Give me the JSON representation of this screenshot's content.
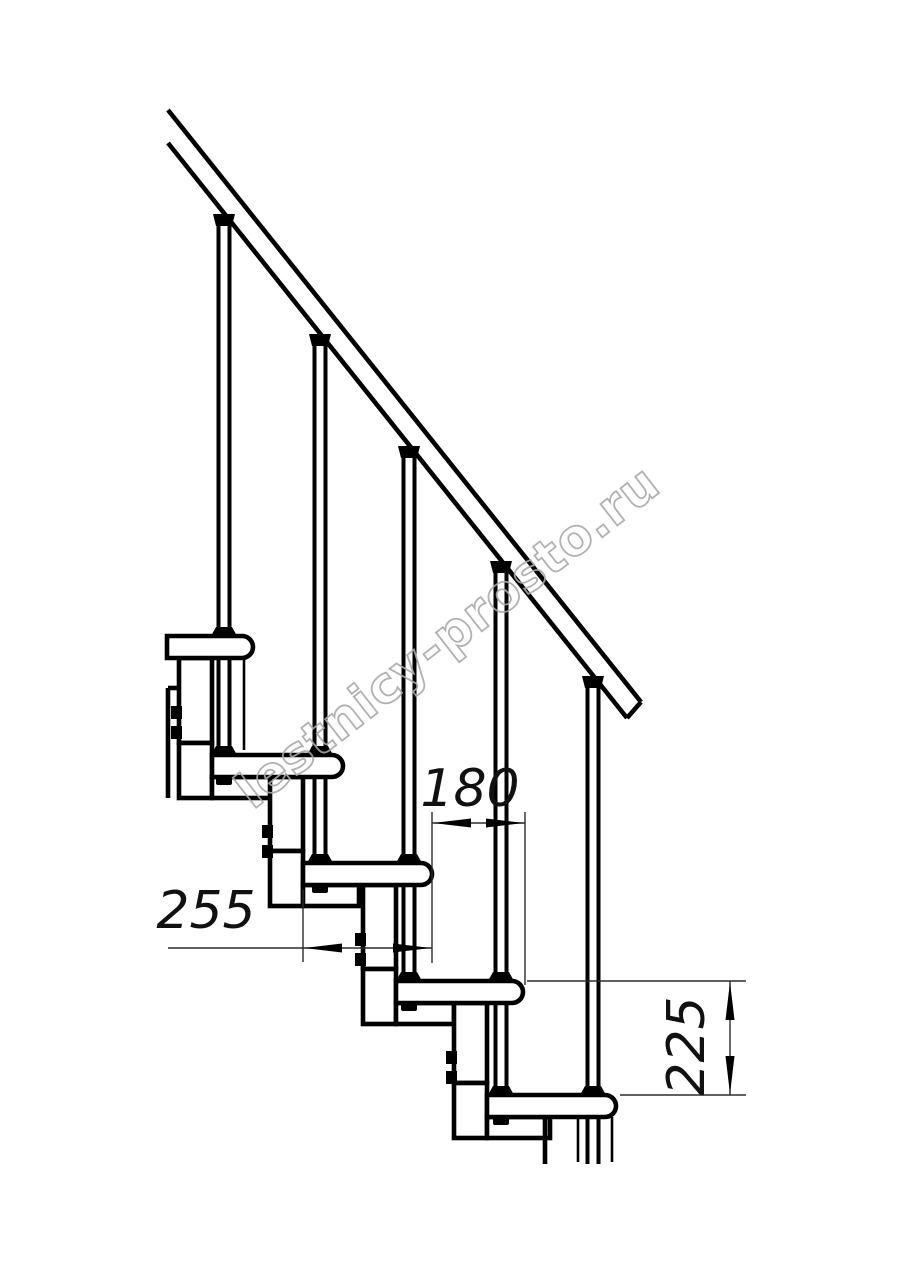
{
  "drawing": {
    "title_hint": "modular staircase side-view technical drawing",
    "watermark_text": "lestnicy-prosto.ru",
    "dimensions": {
      "step_run": "180",
      "tread_depth": "255",
      "riser_height": "225"
    },
    "colors": {
      "line": "#000000",
      "thin_line": "#2b2b2b",
      "watermark": "#a9a9a9",
      "background": "#ffffff"
    }
  }
}
